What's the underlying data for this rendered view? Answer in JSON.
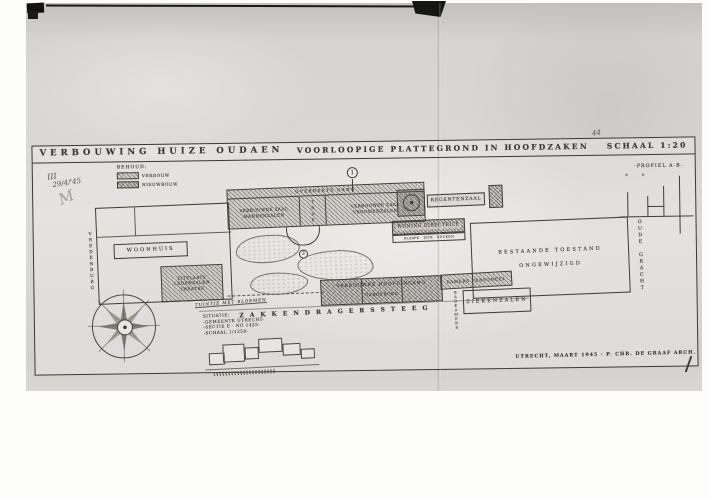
{
  "colors": {
    "ink": "#35322d",
    "paper_light": "#dedcd8",
    "paper_dark": "#c6c4c0"
  },
  "titleblock": {
    "project": "VERBOUWING HUIZE OUDAEN",
    "drawing": "VOORLOOPIGE PLATTEGROND IN HOOFDZAKEN",
    "scale": "SCHAAL 1:20"
  },
  "handwriting": {
    "roman": "III",
    "date": "29/4/'45",
    "flourish": "M",
    "page_note": "44"
  },
  "legend": {
    "heading": "BEHOUD:",
    "item1": "VERBOUW",
    "item2": "NIEUWBOUW"
  },
  "markers": {
    "m1": "1",
    "m2": "2"
  },
  "plan": {
    "gang": "OVERDEKTE GANG",
    "room_left_1": "VERBOUWDE ZAAL",
    "room_left_2": "MANNENZALEN",
    "stair": "TRAP",
    "room_right_1": "VERBOUWDE ZAAL",
    "room_right_2": "VROUWENZALEN",
    "regentenzaal": "REGENTENZAAL",
    "woning": "WONING DIRECTRICE",
    "woning_sub": "SLAAPK · ZITK · KEUKEN",
    "woonhuis": "WOONHUIS",
    "annex_1": "ZITPLAATS",
    "annex_2": "LEDENZALEN",
    "annex_3": "THEATER",
    "garden_note": "TUINTJE MET BLOEMEN",
    "entrance_1": "VERBOUWDE HOOFDINGANG",
    "entrance_2": "GARDEROBE",
    "personeel": "KAMERS PERSONEEL",
    "badkamers": "BADKAMERS",
    "ziekenzalen": "ZIEKENZALEN",
    "hall_1": "BESTAANDE TOESTAND",
    "hall_2": "ONGEWIJZIGD",
    "street_left": "VREDENBURG",
    "street_right": "OUDE GRACHT",
    "street_bottom": "ZAKKENDRAGERSSTEEG"
  },
  "situatie": {
    "l1": "SITUATIE:",
    "l2": "-GEMEENTE UTRECHT-",
    "l3": "-SECTIE E · No 1425-",
    "l4": "-SCHAAL 1/1250-"
  },
  "profile": {
    "label": "-PROFIEL A-B-",
    "marks": "✕  ✕"
  },
  "footer": {
    "credit": "UTRECHT, MAART 1945 · P. CHR. DE GRAAF ARCH."
  }
}
